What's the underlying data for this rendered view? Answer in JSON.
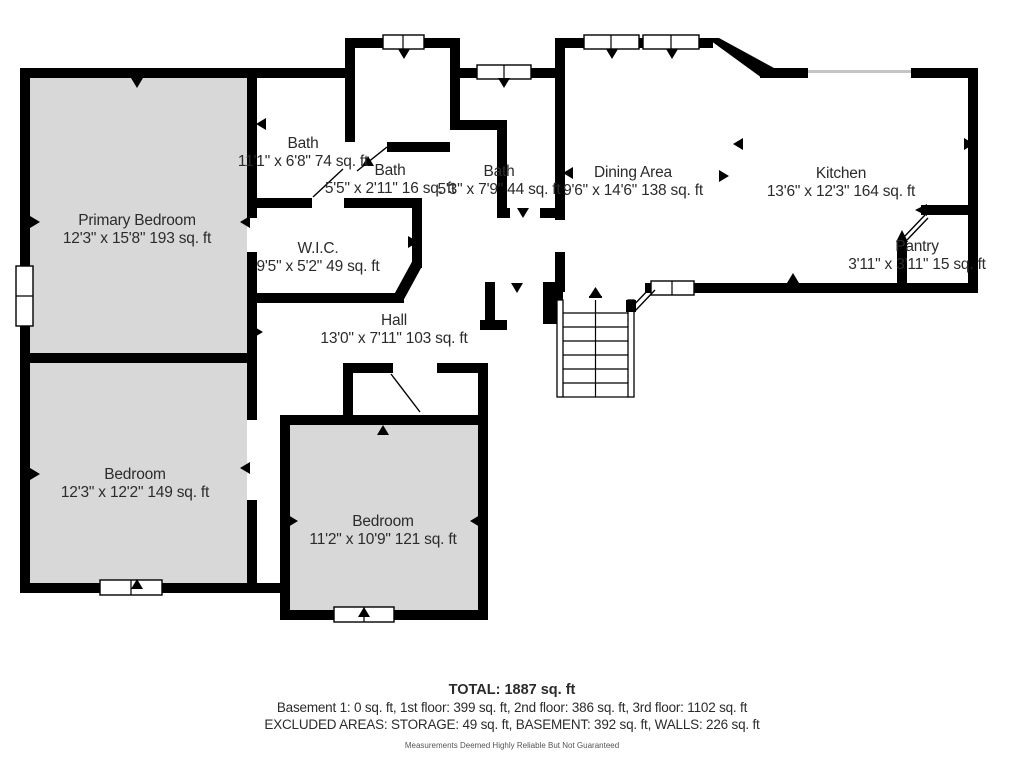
{
  "rooms": {
    "primary_bedroom": {
      "name": "Primary Bedroom",
      "dims": "12'3\" x 15'8\" 193 sq. ft"
    },
    "bath_1": {
      "name": "Bath",
      "dims": "11'1\" x 6'8\" 74 sq. ft"
    },
    "bath_2": {
      "name": "Bath",
      "dims": "5'5\" x 2'11\" 16 sq. ft"
    },
    "bath_3": {
      "name": "Bath",
      "dims": "5'3\" x 7'9\" 44 sq. ft"
    },
    "dining_area": {
      "name": "Dining Area",
      "dims": "9'6\" x 14'6\" 138 sq. ft"
    },
    "kitchen": {
      "name": "Kitchen",
      "dims": "13'6\" x 12'3\" 164 sq. ft"
    },
    "pantry": {
      "name": "Pantry",
      "dims": "3'11\" x 3'11\" 15 sq. ft"
    },
    "wic": {
      "name": "W.I.C.",
      "dims": "9'5\" x 5'2\" 49 sq. ft"
    },
    "hall": {
      "name": "Hall",
      "dims": "13'0\" x 7'11\" 103 sq. ft"
    },
    "bedroom_left": {
      "name": "Bedroom",
      "dims": "12'3\" x 12'2\" 149 sq. ft"
    },
    "bedroom_center": {
      "name": "Bedroom",
      "dims": "11'2\" x 10'9\" 121 sq. ft"
    }
  },
  "summary": {
    "total": "TOTAL: 1887 sq. ft",
    "floors": "Basement 1: 0 sq. ft, 1st floor: 399 sq. ft, 2nd floor: 386 sq. ft, 3rd floor: 1102 sq. ft",
    "excluded": "EXCLUDED AREAS: STORAGE: 49 sq. ft, BASEMENT: 392 sq. ft, WALLS: 226 sq. ft",
    "disclaimer": "Measurements Deemed Highly Reliable But Not Guaranteed"
  },
  "colors": {
    "wall": "#000000",
    "room_fill": "#d8d8d8",
    "text": "#2b2b2b"
  }
}
